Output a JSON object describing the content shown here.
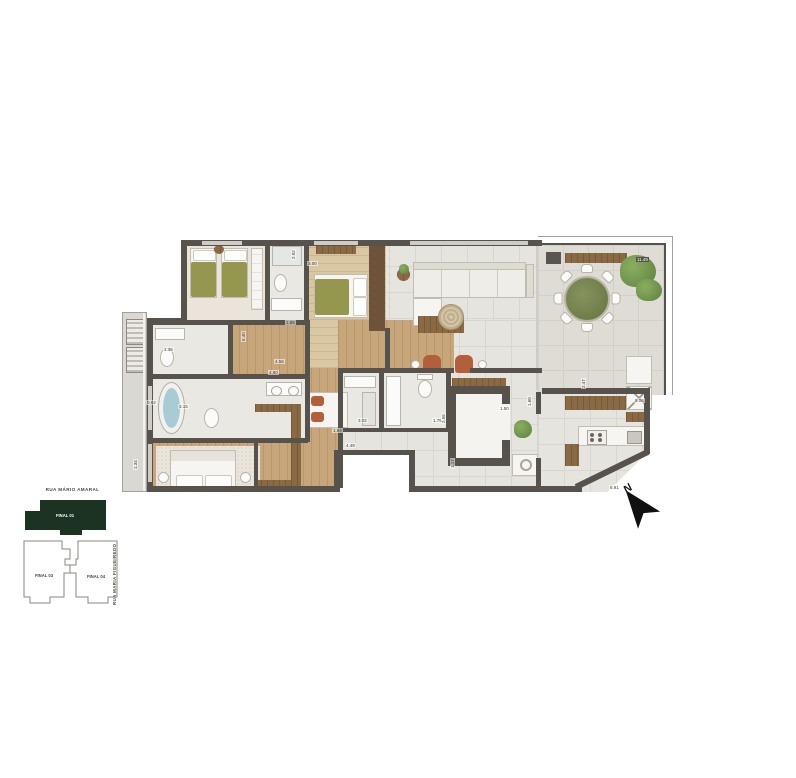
{
  "colors": {
    "wall": "#57524b",
    "wood": "#c7a67c",
    "wood_dark": "#8a6a44",
    "tile": "#e6e4de",
    "terrace_tile": "#dedcd5",
    "carpet": "#eae4da",
    "bed_green": "#95974e",
    "rust": "#b2603c",
    "plant": "#5d8140",
    "water": "#a9ccd4",
    "keyplan_green": "#1c3323"
  },
  "keyplan": {
    "street_top": "RUA MÁRIO AMARAL",
    "street_right": "RUA MARIA FIGUEIREDO",
    "units": {
      "highlight": "FINAL 01",
      "left": "FINAL 03",
      "right": "FINAL 04"
    }
  },
  "compass": {
    "label": "N"
  },
  "floorplan": {
    "dimensions": [
      {
        "v": "1.36",
        "x": 163,
        "y": 347
      },
      {
        "v": "3.15",
        "x": 178,
        "y": 404
      },
      {
        "v": "0.82",
        "x": 146,
        "y": 400
      },
      {
        "v": "1.34",
        "x": 133,
        "y": 470,
        "rot": 1
      },
      {
        "v": "6.40",
        "x": 241,
        "y": 342,
        "rot": 1
      },
      {
        "v": "2.92",
        "x": 291,
        "y": 260,
        "rot": 1
      },
      {
        "v": "3.00",
        "x": 307,
        "y": 261
      },
      {
        "v": "1.85",
        "x": 285,
        "y": 320
      },
      {
        "v": "4.56",
        "x": 274,
        "y": 359
      },
      {
        "v": "4.80",
        "x": 268,
        "y": 370
      },
      {
        "v": "4.49",
        "x": 345,
        "y": 443
      },
      {
        "v": "3.02",
        "x": 357,
        "y": 418
      },
      {
        "v": "1.84",
        "x": 332,
        "y": 428
      },
      {
        "v": "1.75",
        "x": 432,
        "y": 418
      },
      {
        "v": "2.56",
        "x": 441,
        "y": 424,
        "rot": 1
      },
      {
        "v": "1.50",
        "x": 499,
        "y": 406
      },
      {
        "v": "1.60",
        "x": 527,
        "y": 407,
        "rot": 1
      },
      {
        "v": "1.17",
        "x": 450,
        "y": 469,
        "rot": 1
      },
      {
        "v": "2.47",
        "x": 581,
        "y": 389,
        "rot": 1
      },
      {
        "v": "5.06",
        "x": 634,
        "y": 398
      },
      {
        "v": "6.91",
        "x": 609,
        "y": 485
      },
      {
        "v": "11.49",
        "x": 636,
        "y": 257,
        "chip": 1
      }
    ]
  }
}
